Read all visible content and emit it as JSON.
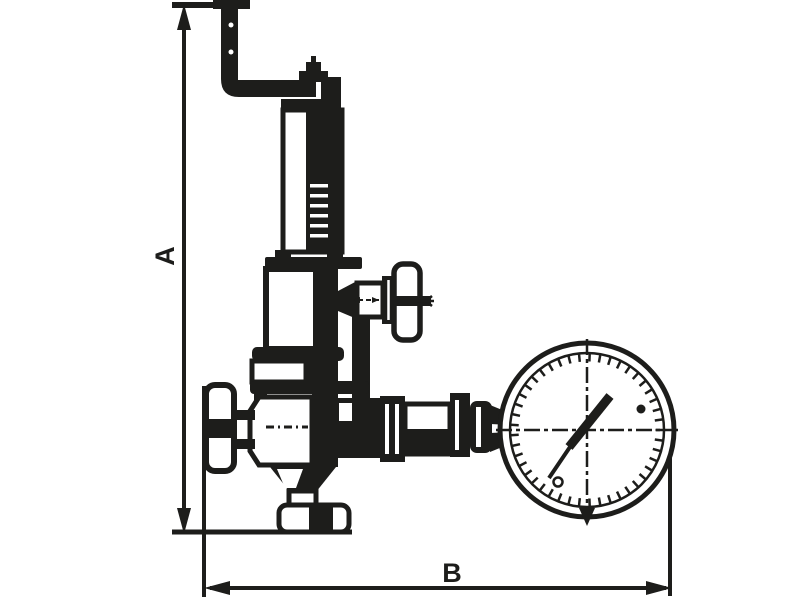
{
  "drawing": {
    "dimension_labels": {
      "a": "A",
      "b": "B"
    },
    "colors": {
      "ink": "#1d1d1b",
      "background": "#ffffff"
    }
  }
}
